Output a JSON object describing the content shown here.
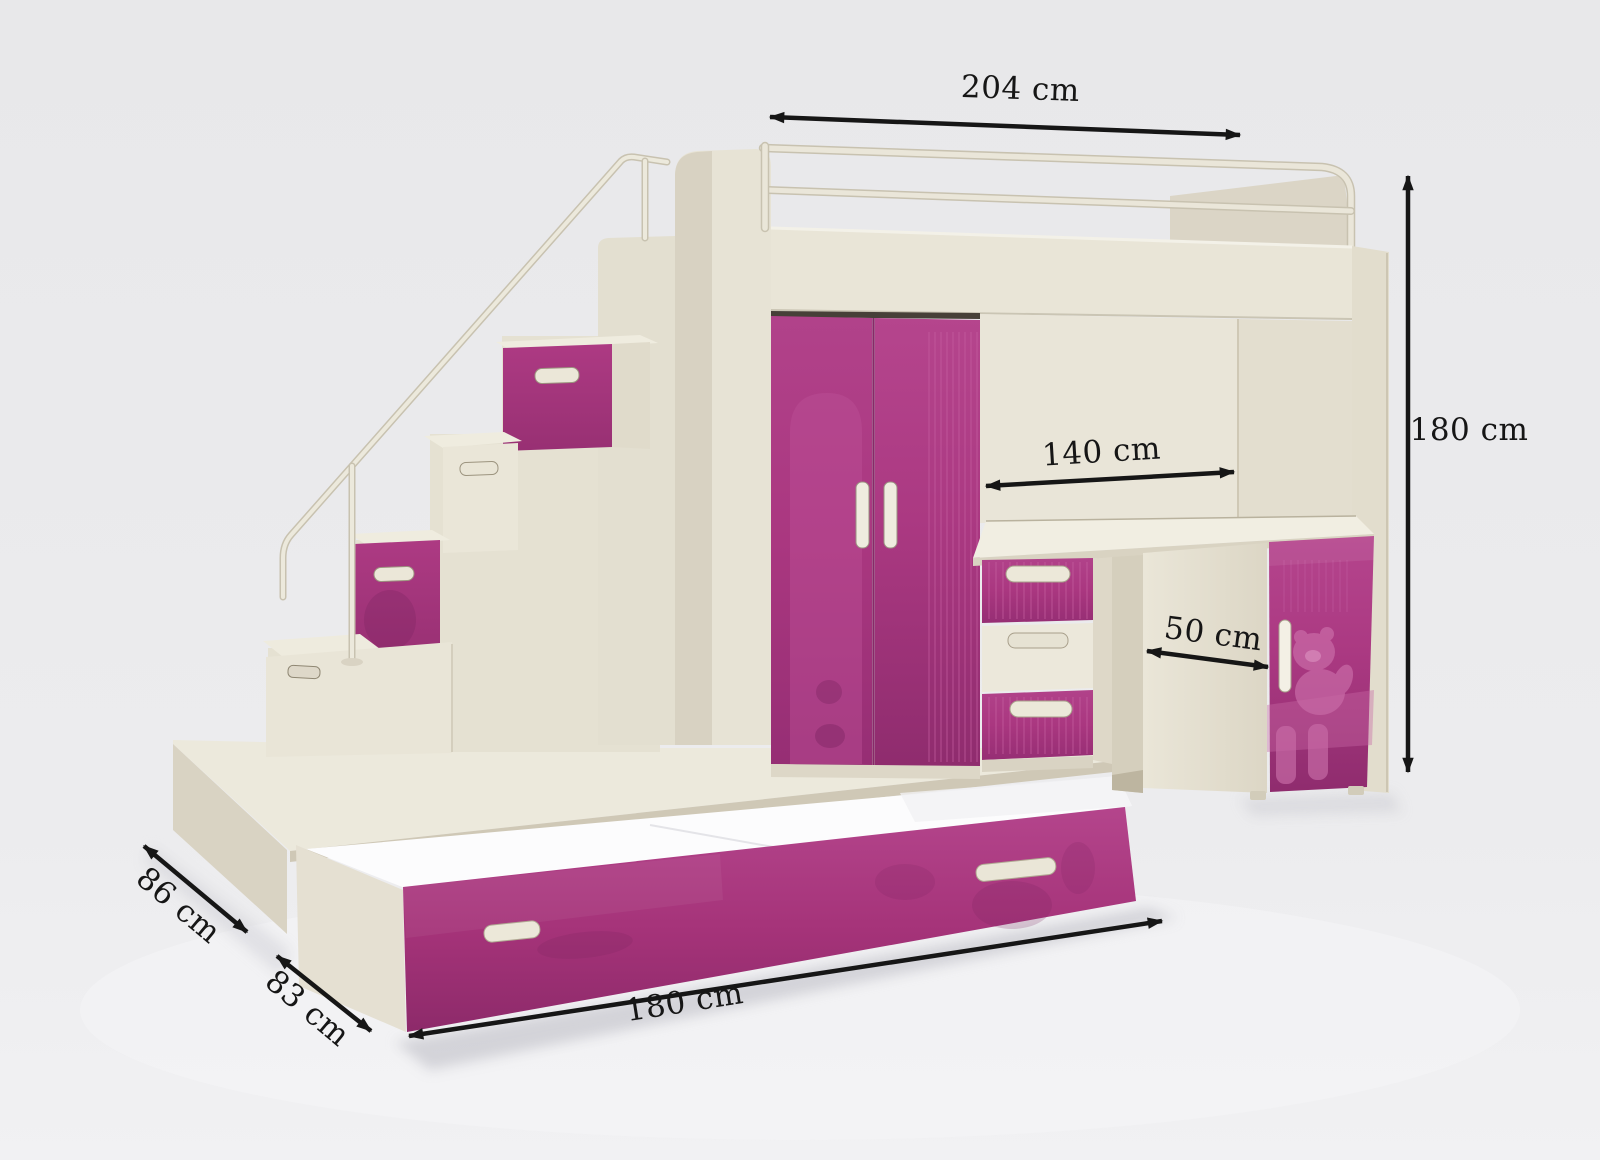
{
  "colors": {
    "annotation_ink": "#161616",
    "accent_pink": "#b0408a",
    "body_cream": "#e8e4d6",
    "mattress_white": "#fcfcfd",
    "background": "#ebebed"
  },
  "dimensions": {
    "top_width": "204 cm",
    "overall_height": "180 cm",
    "desk_width": "140 cm",
    "cabinet_depth": "50 cm",
    "base_depth": "86 cm",
    "trundle_depth": "83 cm",
    "trundle_length": "180 cm"
  }
}
